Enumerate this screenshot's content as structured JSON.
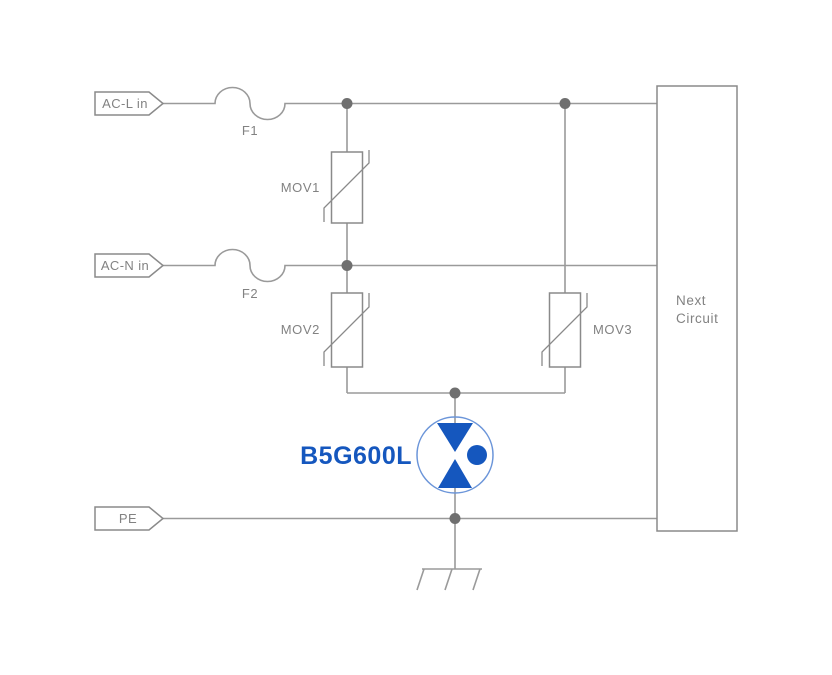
{
  "diagram": {
    "input_tags": {
      "ac_l": "AC-L in",
      "ac_n": "AC-N in",
      "pe": "PE"
    },
    "fuses": {
      "f1": "F1",
      "f2": "F2"
    },
    "varistors": {
      "mov1": "MOV1",
      "mov2": "MOV2",
      "mov3": "MOV3"
    },
    "gdt": {
      "label": "B5G600L"
    },
    "next_circuit": {
      "line1": "Next",
      "line2": "Circuit"
    },
    "colors": {
      "background": "#ffffff",
      "wire": "#9a9a9a",
      "junction": "#6f6f6f",
      "component_outline": "#8a8a8a",
      "label_text": "#828282",
      "gdt_blue": "#1557be",
      "gdt_circle": "#6b95d9"
    }
  }
}
